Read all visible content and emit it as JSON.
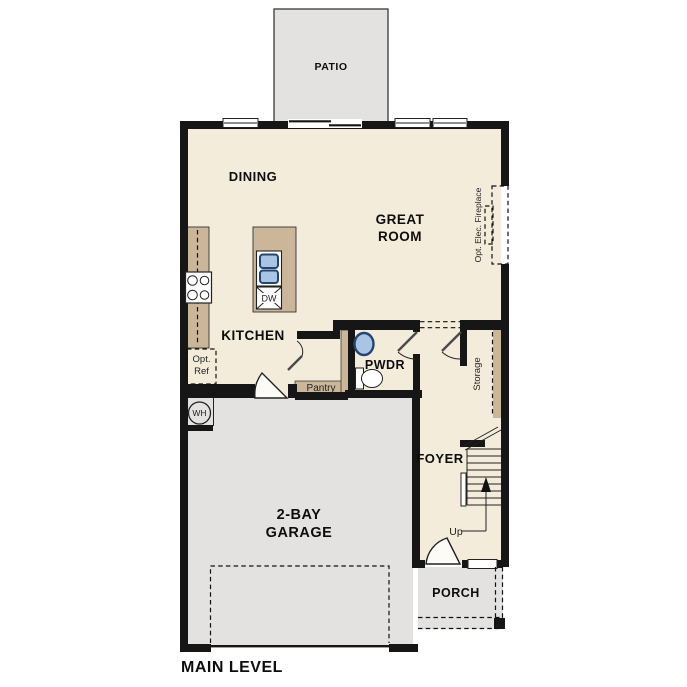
{
  "title": "MAIN LEVEL",
  "rooms": {
    "patio": "PATIO",
    "dining": "DINING",
    "great_room_line1": "GREAT",
    "great_room_line2": "ROOM",
    "kitchen": "KITCHEN",
    "pwdr": "PWDR",
    "foyer": "FOYER",
    "garage_line1": "2-BAY",
    "garage_line2": "GARAGE",
    "porch": "PORCH"
  },
  "labels": {
    "dishwasher": "DW",
    "opt_ref_line1": "Opt.",
    "opt_ref_line2": "Ref",
    "pantry": "Pantry",
    "storage": "Storage",
    "stairs_up": "Up",
    "water_heater": "WH",
    "fireplace": "Opt. Elec. Fireplace"
  },
  "colors": {
    "floor_cream": "#f4ecdb",
    "concrete_gray": "#e3e2e0",
    "cabinet_tan": "#ccb69a",
    "wall_black": "#161616",
    "sink_blue": "#a9c4e4",
    "sink_rim_navy": "#24456e"
  }
}
